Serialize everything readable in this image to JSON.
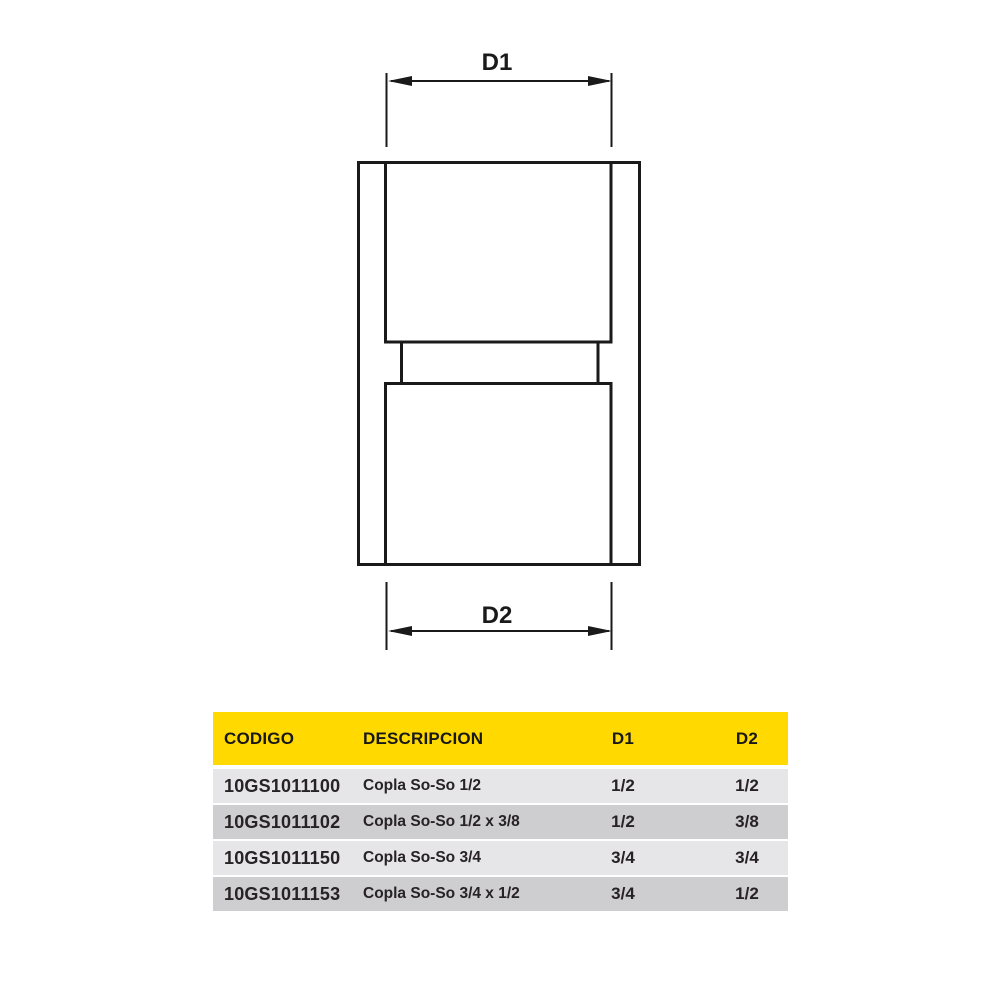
{
  "page": {
    "background": "#ffffff"
  },
  "diagram": {
    "type": "coupling-front-view",
    "top_dimension_label": "D1",
    "bottom_dimension_label": "D2",
    "line_color": "#1a1a1a"
  },
  "table": {
    "header": {
      "codigo": "CODIGO",
      "descripcion": "DESCRIPCION",
      "d1": "D1",
      "d2": "D2"
    },
    "rows": [
      {
        "codigo": "10GS1011100",
        "descripcion": "Copla So-So 1/2",
        "d1": "1/2",
        "d2": "1/2"
      },
      {
        "codigo": "10GS1011102",
        "descripcion": "Copla So-So 1/2 x 3/8",
        "d1": "1/2",
        "d2": "3/8"
      },
      {
        "codigo": "10GS1011150",
        "descripcion": "Copla So-So 3/4",
        "d1": "3/4",
        "d2": "3/4"
      },
      {
        "codigo": "10GS1011153",
        "descripcion": "Copla So-So 3/4 x 1/2",
        "d1": "3/4",
        "d2": "1/2"
      }
    ],
    "colors": {
      "header_bg": "#ffd900",
      "row_light": "#e6e5e7",
      "row_dark": "#cecdd0",
      "text_color": "#272225"
    }
  }
}
